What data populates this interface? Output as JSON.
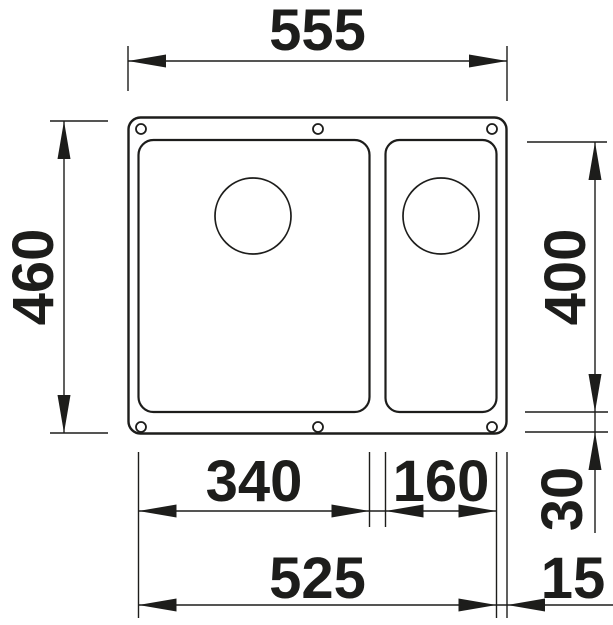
{
  "colors": {
    "line": "#1d1d1b",
    "background": "#ffffff"
  },
  "dimensions": {
    "overall_width": "555",
    "overall_depth": "460",
    "bowl_depth": "400",
    "main_bowl_width": "340",
    "half_bowl_width": "160",
    "rim_bottom_offset": "30",
    "bowls_span_width": "525",
    "rim_right_offset": "15"
  }
}
